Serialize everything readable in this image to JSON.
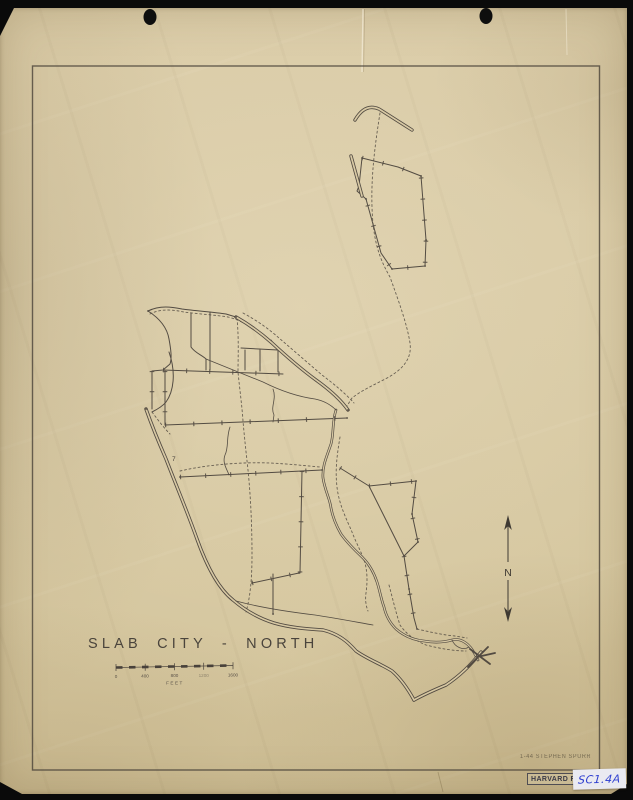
{
  "scan": {
    "background_color": "#0a0a0a",
    "paper_color": "#d8c9a4",
    "ink_color": "#48413a"
  },
  "map": {
    "title": "SLAB CITY - NORTH",
    "compartment_label": "7",
    "north_arrow": {
      "label": "N"
    },
    "scale_bar": {
      "tick_labels": [
        "0",
        "400",
        "800",
        "1200",
        "1600"
      ],
      "unit_label": "FEET"
    },
    "credit_line": "1-44  STEPHEN SPURR",
    "stamp": {
      "text": "HARVARD FOREST"
    },
    "catalog_label": {
      "text": "SC1.4A",
      "ink_color": "#2f3fd0"
    }
  }
}
